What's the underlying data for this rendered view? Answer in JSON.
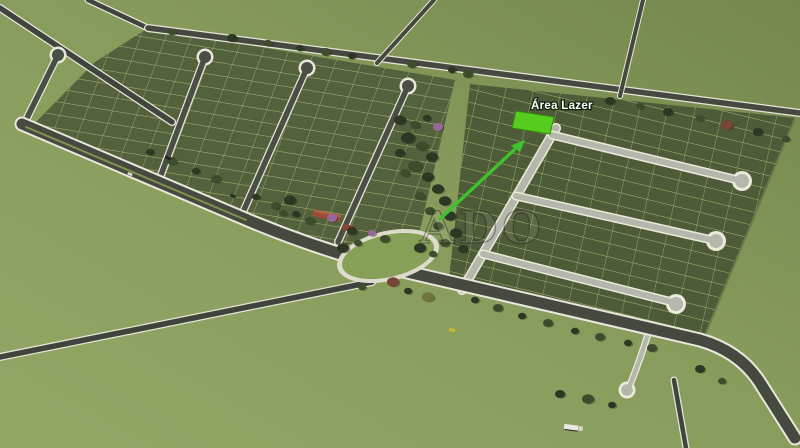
{
  "description": "3D aerial rendering of a residential land subdivision (loteamento) with roads, lot grids, cul-de-sac streets, trees, a roundabout green and one lot highlighted by a green arrow",
  "annotation": {
    "label": "Área Lazer",
    "label_color": "#ffffff",
    "arrow_color": "#3dc42d",
    "highlight_color": "#55cc1e"
  },
  "watermark": {
    "partial_text": "ADO"
  },
  "palette": {
    "field_light": "#93a765",
    "field_dark": "#75874d",
    "plot_dark": "#52603c",
    "plot_line": "#b9c97e",
    "asphalt_dark": "#4a4f45",
    "street_light": "#b4b7ac",
    "curb_white": "#e9e7da",
    "roof_red": "#9a4c38"
  }
}
